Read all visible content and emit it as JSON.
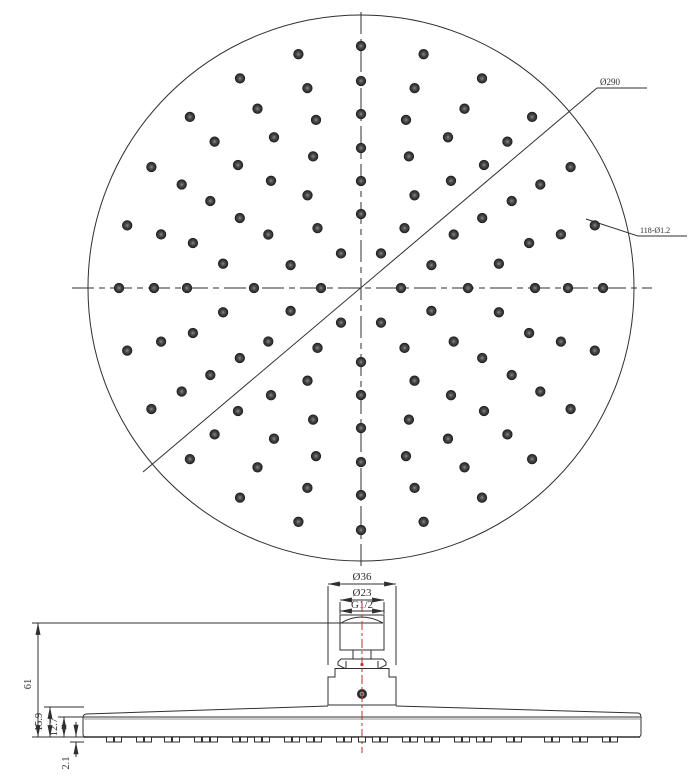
{
  "drawing": {
    "background": "#ffffff",
    "line_color": "#2f2f2f",
    "hole_color": "#3a3a3a",
    "red_centerline_color": "#bf3030"
  },
  "top_view": {
    "diameter_label": "Ø290",
    "holes_label": "118-Ø1.2",
    "hole_rings": [
      {
        "radius": 40,
        "count": 6,
        "start_deg": 0
      },
      {
        "radius": 74,
        "count": 10,
        "start_deg": 90
      },
      {
        "radius": 107,
        "count": 12,
        "start_deg": 0
      },
      {
        "radius": 140,
        "count": 18,
        "start_deg": 90
      },
      {
        "radius": 174,
        "count": 24,
        "start_deg": 0
      },
      {
        "radius": 207,
        "count": 24,
        "start_deg": 0
      },
      {
        "radius": 242,
        "count": 24,
        "start_deg": 0
      }
    ]
  },
  "side_view": {
    "dim_width_outer": "Ø36",
    "dim_width_inner": "Ø23",
    "dim_thread": "G1/2",
    "dim_height_total": "61",
    "dim_height_edge": "15.9",
    "dim_height_rim": "12.7",
    "dim_nozzle_protrusion": "2.1",
    "nozzle_offsets": [
      -252,
      -244,
      -222,
      -214,
      -194,
      -186,
      -164,
      -156,
      -148,
      -126,
      -118,
      -104,
      -96,
      -74,
      -66,
      -52,
      -44,
      -22,
      -14,
      0,
      14,
      22,
      44,
      52,
      66,
      74,
      96,
      104,
      118,
      126,
      148,
      156,
      186,
      194,
      214,
      222,
      244,
      252
    ]
  }
}
